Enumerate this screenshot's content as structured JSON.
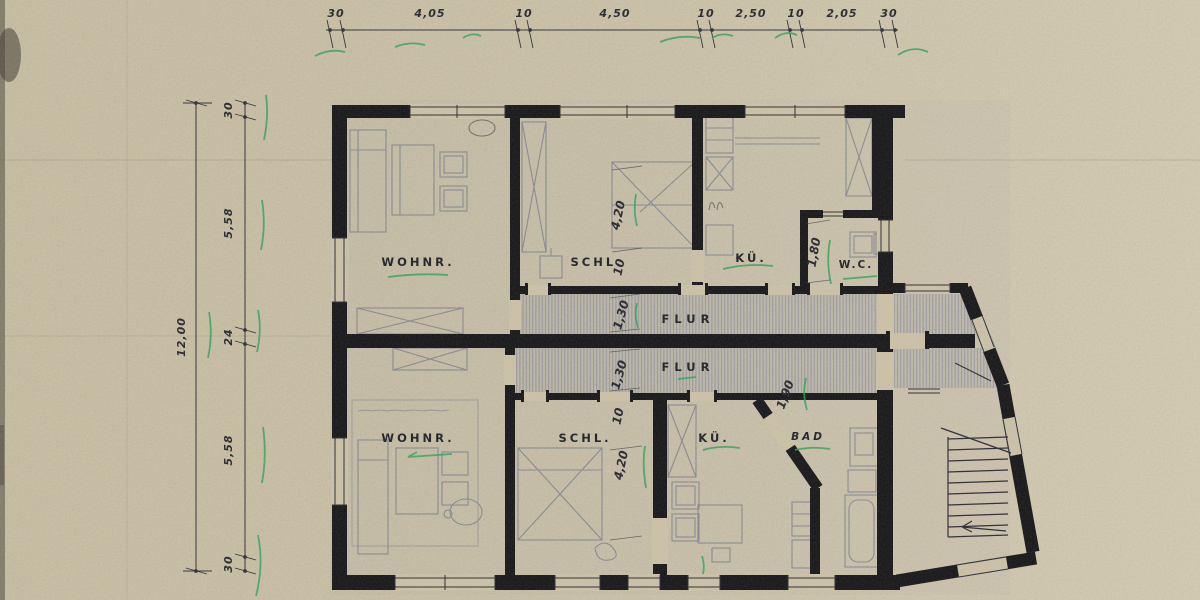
{
  "drawing_title": "floor-plan",
  "colors": {
    "paper": "#cbc1a6",
    "ink": "#26272e",
    "wall": "#161619",
    "pencil": "#5f6880",
    "hatch": "#70788f",
    "green": "#2da157"
  },
  "dim_top": {
    "values": [
      "30",
      "4,05",
      "10",
      "4,50",
      "10",
      "2,50",
      "10",
      "2,05",
      "30"
    ]
  },
  "dim_left": {
    "total": "12,00",
    "values": [
      "30",
      "5,58",
      "24",
      "5,58",
      "30"
    ]
  },
  "dims_inner": {
    "schl_top_width": "4,20",
    "schl_top_wall": "10",
    "flur_top_width": "1,30",
    "flur_bottom_width": "1,30",
    "wc_width": "1,80",
    "bad_width": "1,90",
    "schl_bottom_wall": "10",
    "schl_bottom_width": "4,20"
  },
  "labels": {
    "wohnr_top": "WOHNR.",
    "schl_top": "SCHL.",
    "kue_top": "KÜ.",
    "wc": "W.C.",
    "flur_top": "FLUR",
    "flur_bottom": "FLUR",
    "wohnr_bottom": "WOHNR.",
    "schl_bottom": "SCHL.",
    "kue_bottom": "KÜ.",
    "bad": "BAD"
  }
}
